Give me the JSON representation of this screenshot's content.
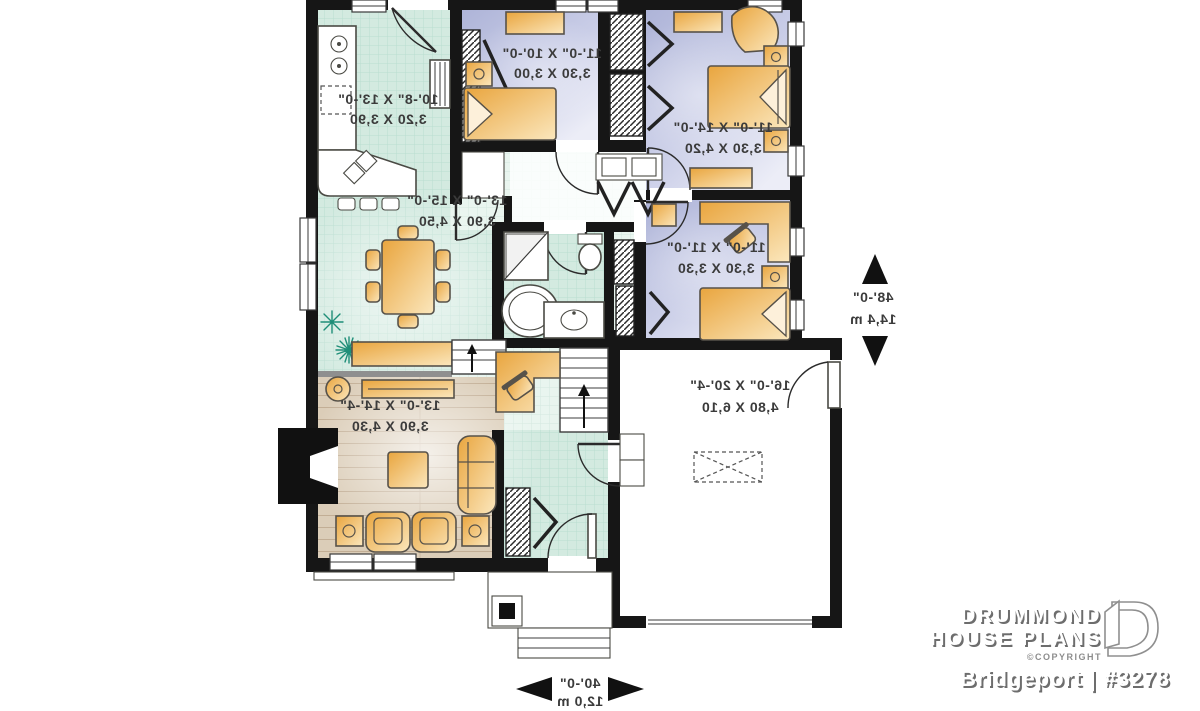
{
  "rooms": {
    "kitchen": {
      "imperial": "10'-8\" X 13'-0\"",
      "metric": "3,20 X 3,90"
    },
    "dining": {
      "imperial": "13'-0\" X 15'-0\"",
      "metric": "3,90 X 4,50"
    },
    "living": {
      "imperial": "13'-0\" X 14'-4\"",
      "metric": "3,90 X 4,30"
    },
    "bedroom2": {
      "imperial": "11'-0\" X 10'-0\"",
      "metric": "3,30 X 3,00"
    },
    "master": {
      "imperial": "11'-0\" X 14'-0\"",
      "metric": "3,30 X 4,20"
    },
    "bedroom3": {
      "imperial": "11'-0\" X 11'-0\"",
      "metric": "3,30 X 3,30"
    },
    "garage": {
      "imperial": "16'-0\" X 20'-4\"",
      "metric": "4,80 X 6,10"
    }
  },
  "overall": {
    "depth_ft": "48'-0\"",
    "depth_m": "14,4 m",
    "width_ft": "40'-0\"",
    "width_m": "12,0 m"
  },
  "branding": {
    "brand_line1": "DRUMMOND",
    "brand_line2": "HOUSE PLANS",
    "copyright": "©COPYRIGHT",
    "plan_name": "Bridgeport | #3278"
  },
  "colors": {
    "wall": "#161616",
    "tile_floor": "#d3eae0",
    "bedroom_floor": "#bcc1e0",
    "wood_floor": "#dbcdb8",
    "furniture": "#f0b964",
    "plant": "#1f8e78"
  }
}
